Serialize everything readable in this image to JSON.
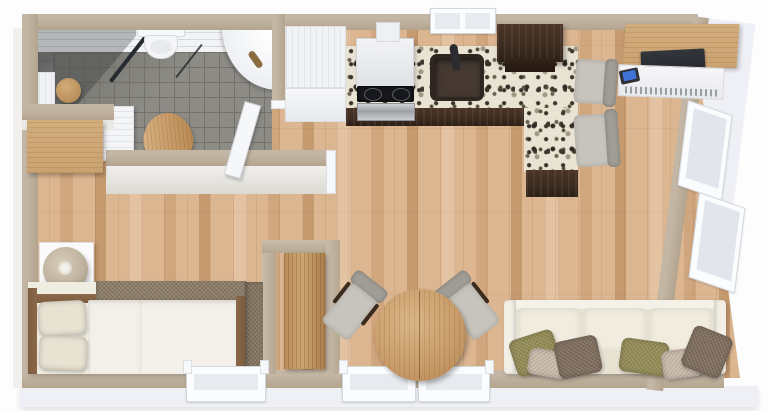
{
  "scene": {
    "type": "3d-floor-plan-top-down-render",
    "description": "Photorealistic 3D top view of a small studio apartment floor plan, no visible text labels",
    "rooms": [
      {
        "name": "bathroom",
        "floor": "gray-tile",
        "walls": "white-tile",
        "items": [
          "corner-shower-enclosure",
          "wooden-stool",
          "toilet",
          "corner-sink-with-bronze-faucet",
          "wall-radiator",
          "white-storage-cabinet",
          "wooden-bath-mat",
          "white-door-open"
        ]
      },
      {
        "name": "bedroom",
        "floor": "light-oak-plank",
        "items": [
          "wall-mounted-wood-desk",
          "white-nightstand",
          "drum-shade-table-lamp",
          "bed-with-wood-frame",
          "two-cream-pillows",
          "white-duvet",
          "brown-throw-blanket",
          "window"
        ]
      },
      {
        "name": "closet-nook",
        "floor": "light-oak-plank",
        "items": [
          "tall-wood-wardrobe"
        ]
      },
      {
        "name": "kitchen",
        "floor": "light-oak-plank",
        "items": [
          "tall-white-fridge-cabinet",
          "range-hood",
          "stove-with-black-cooktop-and-steel-oven",
          "l-shaped-speckled-granite-counter",
          "dark-undermount-sink-with-black-faucet",
          "window-above-sink",
          "espresso-wall-cabinet",
          "espresso-base-cabinets",
          "peninsula-counter",
          "two-gray-bar-chairs"
        ]
      },
      {
        "name": "living-dining",
        "floor": "light-oak-plank",
        "items": [
          "round-wood-dining-table",
          "two-gray-dining-chairs-with-espresso-arms",
          "cream-three-seat-sofa",
          "six-throw-pillows",
          "wood-top-media-desk",
          "flat-tv",
          "blue-screen-laptop",
          "two-windows-bottom-wall",
          "two-windows-right-wall"
        ]
      }
    ],
    "pillow_colors_left_to_right": [
      "olive",
      "taupe",
      "brown",
      "olive",
      "taupe",
      "brown"
    ]
  },
  "palette": {
    "wall_top": "#b3a48e",
    "wall_light": "#c3b6a4",
    "outer_face": "#eef0f6",
    "wood_a": "#dcb691",
    "wood_b": "#e4c3a2",
    "wood_c": "#d0a67e",
    "wood_d": "#c69a6f",
    "tile_floor": "#8c8b86",
    "tile_grout": "#73716a",
    "tile_wall": "#f2f3f5",
    "espresso": "#3c2b1f",
    "granite_base": "#e9e3d3",
    "sofa_cream": "#e8e2d3",
    "cushion_cream": "#f1ecdf",
    "pillow_olive": "#948c56",
    "pillow_taupe": "#cbbbab",
    "pillow_brown": "#7f6e5e",
    "table_wood": "#c79c69",
    "chair_gray": "#c7c4bd",
    "chair_back": "#a09d96",
    "duvet_white": "#f2f0e8",
    "bed_pillow": "#e8e2d2",
    "throw_brown": "#8b7b67",
    "bedframe_wood": "#8b684a",
    "lamp_shade": "#c0b4a0",
    "desk_wood": "#c9a271",
    "tv_black": "#25282c",
    "laptop_blue": "#3e73d8",
    "sink_dark": "#453931",
    "faucet_bronze": "#8a6c40",
    "door_white": "#f6f7f9",
    "glass_dark": "#262a31"
  }
}
